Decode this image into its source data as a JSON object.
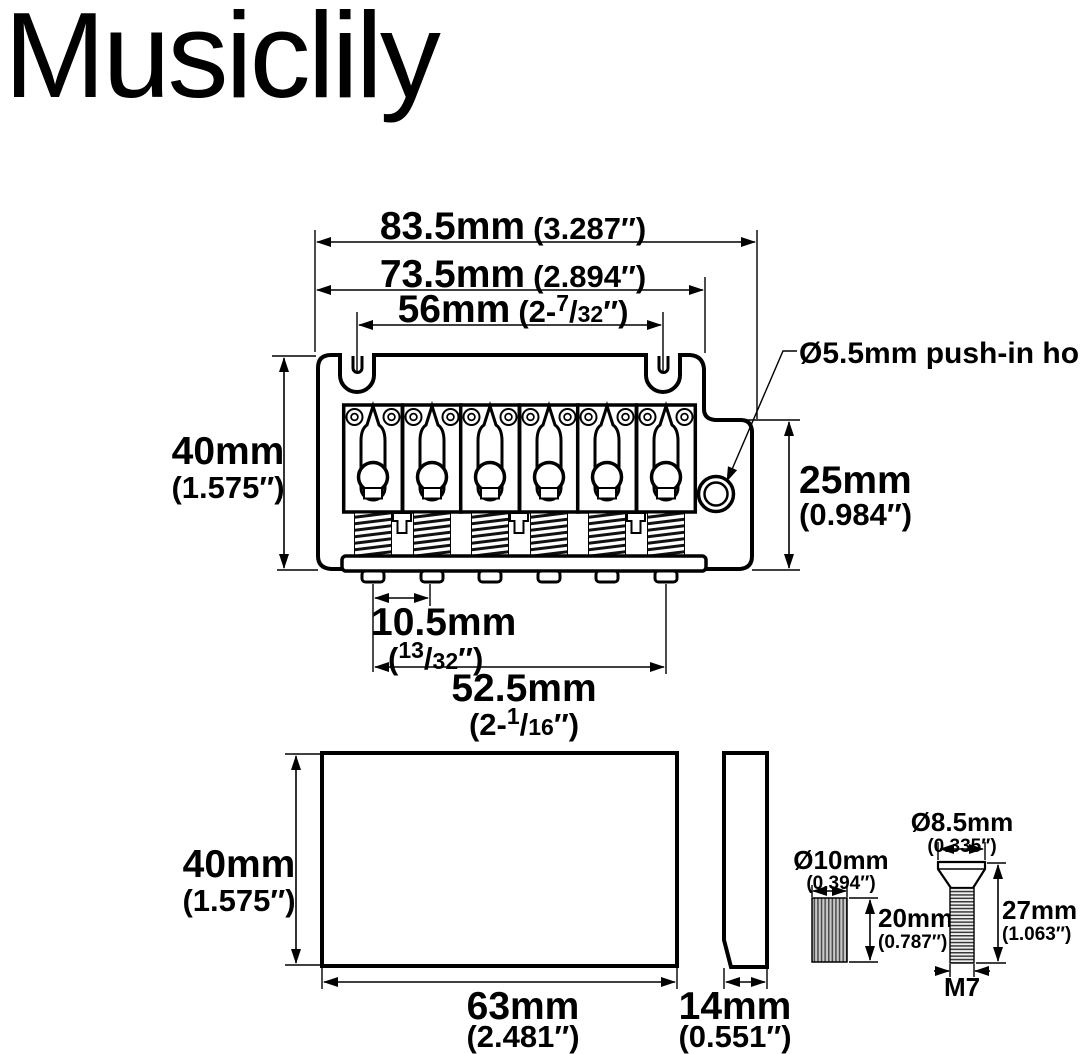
{
  "brand": "Musiclily",
  "colors": {
    "ink": "#000000",
    "background": "#ffffff"
  },
  "top_view": {
    "overall_width": {
      "mm": "83.5mm",
      "inch": "(3.287″)"
    },
    "plate_width": {
      "mm": "73.5mm",
      "inch": "(2.894″)"
    },
    "mounting_span": {
      "mm": "56mm",
      "frac_pre": "(2-",
      "frac_num": "7",
      "frac_slash": "/",
      "frac_den": "32",
      "frac_post": "″)"
    },
    "plate_height": {
      "mm": "40mm",
      "inch": "(1.575″)"
    },
    "right_height": {
      "mm": "25mm",
      "inch": "(0.984″)"
    },
    "string_spacing": {
      "mm": "10.5mm",
      "frac_pre": "(",
      "frac_num": "13",
      "frac_slash": "/",
      "frac_den": "32",
      "frac_post": "″)"
    },
    "string_span": {
      "mm": "52.5mm",
      "frac_pre": "(2-",
      "frac_num": "1",
      "frac_slash": "/",
      "frac_den": "16",
      "frac_post": "″)"
    },
    "pushin_hole_note": "Ø5.5mm push-in hole"
  },
  "block_views": {
    "front_height": {
      "mm": "40mm",
      "inch": "(1.575″)"
    },
    "front_width": {
      "mm": "63mm",
      "inch": "(2.481″)"
    },
    "side_thickness": {
      "mm": "14mm",
      "inch": "(0.551″)"
    }
  },
  "hardware": {
    "insert_diameter": {
      "mm": "Ø10mm",
      "inch": "(0.394″)"
    },
    "insert_length": {
      "mm": "20mm",
      "inch": "(0.787″)"
    },
    "screw_head_diameter": {
      "mm": "Ø8.5mm",
      "inch": "(0.335″)"
    },
    "screw_length": {
      "mm": "27mm",
      "inch": "(1.063″)"
    },
    "screw_thread": "M7"
  }
}
